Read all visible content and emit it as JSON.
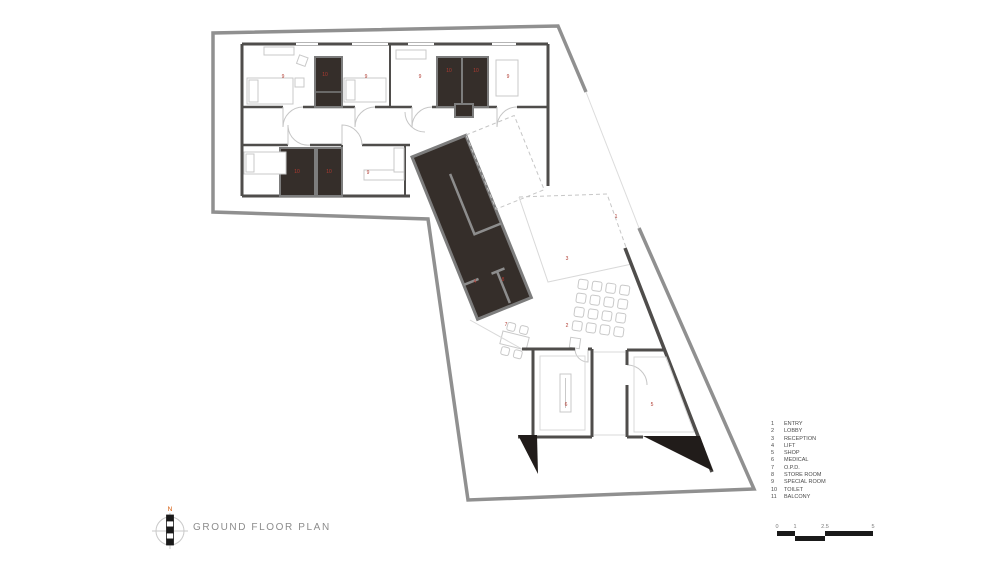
{
  "title": "GROUND FLOOR PLAN",
  "north": {
    "label": "N"
  },
  "legend": {
    "items": [
      {
        "num": "1",
        "label": "ENTRY"
      },
      {
        "num": "2",
        "label": "LOBBY"
      },
      {
        "num": "3",
        "label": "RECEPTION"
      },
      {
        "num": "4",
        "label": "LIFT"
      },
      {
        "num": "5",
        "label": "SHOP"
      },
      {
        "num": "6",
        "label": "MEDICAL"
      },
      {
        "num": "7",
        "label": "O.P.D."
      },
      {
        "num": "8",
        "label": "STORE ROOM"
      },
      {
        "num": "9",
        "label": "SPECIAL ROOM"
      },
      {
        "num": "10",
        "label": "TOILET"
      },
      {
        "num": "11",
        "label": "BALCONY"
      }
    ]
  },
  "scale_bar": {
    "ticks": [
      "0",
      "1",
      "2.5",
      "5"
    ]
  },
  "plan": {
    "colors": {
      "wall": "#4f4d4b",
      "boundary": "#909090",
      "core": "#352e2a",
      "wedge": "#211c1a",
      "label": "#b03a30",
      "accent": "#d35400",
      "scale": "#1a1a1a"
    },
    "room_labels": [
      {
        "num": "9",
        "x": 283,
        "y": 78
      },
      {
        "num": "10",
        "x": 325,
        "y": 76
      },
      {
        "num": "9",
        "x": 366,
        "y": 78
      },
      {
        "num": "9",
        "x": 420,
        "y": 78
      },
      {
        "num": "10",
        "x": 449,
        "y": 72
      },
      {
        "num": "10",
        "x": 476,
        "y": 72
      },
      {
        "num": "9",
        "x": 508,
        "y": 78
      },
      {
        "num": "10",
        "x": 297,
        "y": 173
      },
      {
        "num": "10",
        "x": 329,
        "y": 173
      },
      {
        "num": "9",
        "x": 368,
        "y": 174
      },
      {
        "num": "4",
        "x": 475,
        "y": 283
      },
      {
        "num": "8",
        "x": 503,
        "y": 281
      },
      {
        "num": "3",
        "x": 567,
        "y": 260
      },
      {
        "num": "1",
        "x": 616,
        "y": 218
      },
      {
        "num": "2",
        "x": 567,
        "y": 327
      },
      {
        "num": "7",
        "x": 506,
        "y": 326
      },
      {
        "num": "6",
        "x": 566,
        "y": 406
      },
      {
        "num": "5",
        "x": 652,
        "y": 406
      }
    ]
  }
}
